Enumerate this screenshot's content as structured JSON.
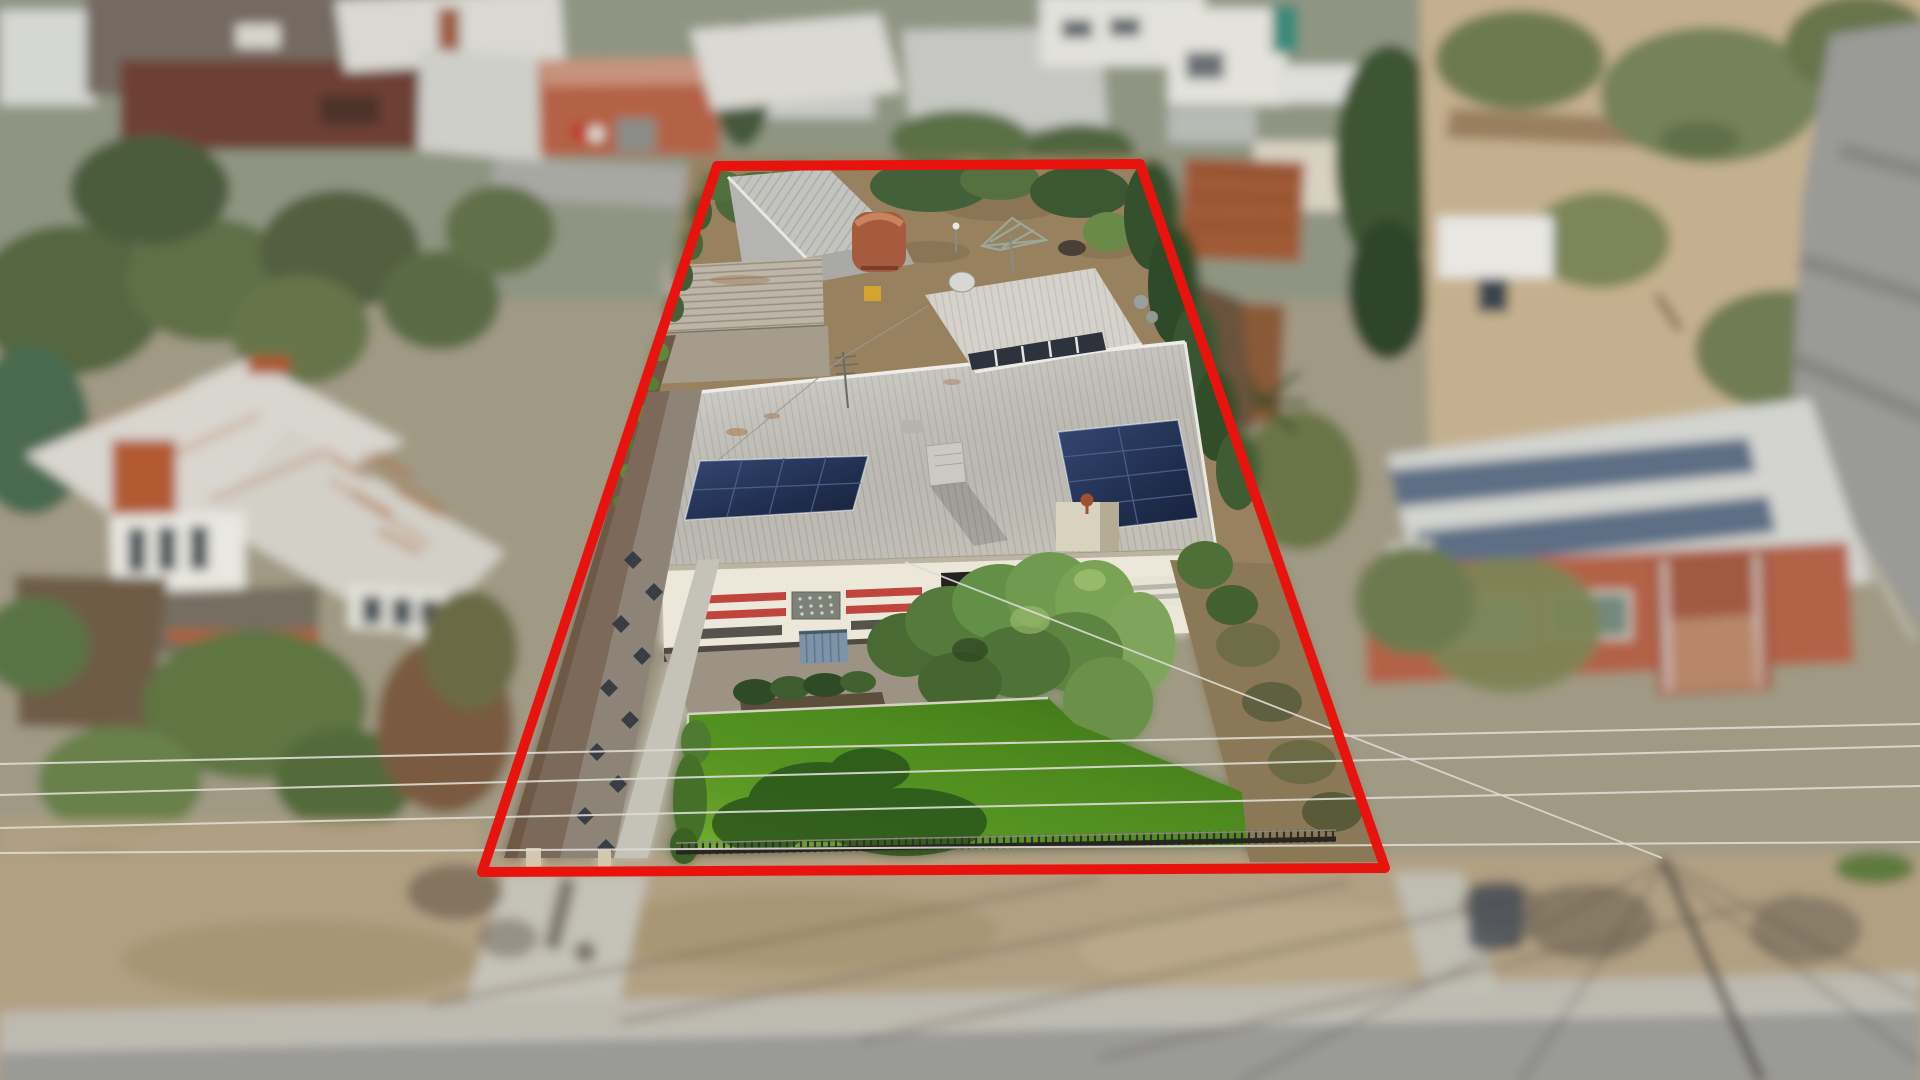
{
  "scene": {
    "type": "aerial-property-photo-with-boundary-annotation",
    "boundary": {
      "points": "717,166 1140,164 1385,868 482,872",
      "stroke": "#e8130c",
      "stroke_width": "10"
    },
    "colors": {
      "boundary_red": "#e8130c",
      "lawn_green": "#509020",
      "solar_panel_navy": "#1d2b4d",
      "roof_light_grey": "#cfccc4",
      "rear_wing_roof": "#d4d2cb",
      "facade_cream": "#ece7d8",
      "awning_red": "#c0453c",
      "driveway_grey": "#8d8377",
      "driveway_red_paving": "#7d695a",
      "diamond_navy": "#2d3440",
      "backyard_dirt": "#97815f",
      "hedge_green": "#4c6b38",
      "brick_orange": "#b26247",
      "rust_orange": "#a05a36",
      "asphalt_grey": "#9a9a97",
      "nature_strip_tan": "#b2a083",
      "sandy_ground": "#c4b08e",
      "left_house_roof": "#d9d6cf",
      "bench_blue": "#7d93a8",
      "front_fence_dark": "#27251f",
      "concrete_light": "#c5c2b8"
    }
  }
}
